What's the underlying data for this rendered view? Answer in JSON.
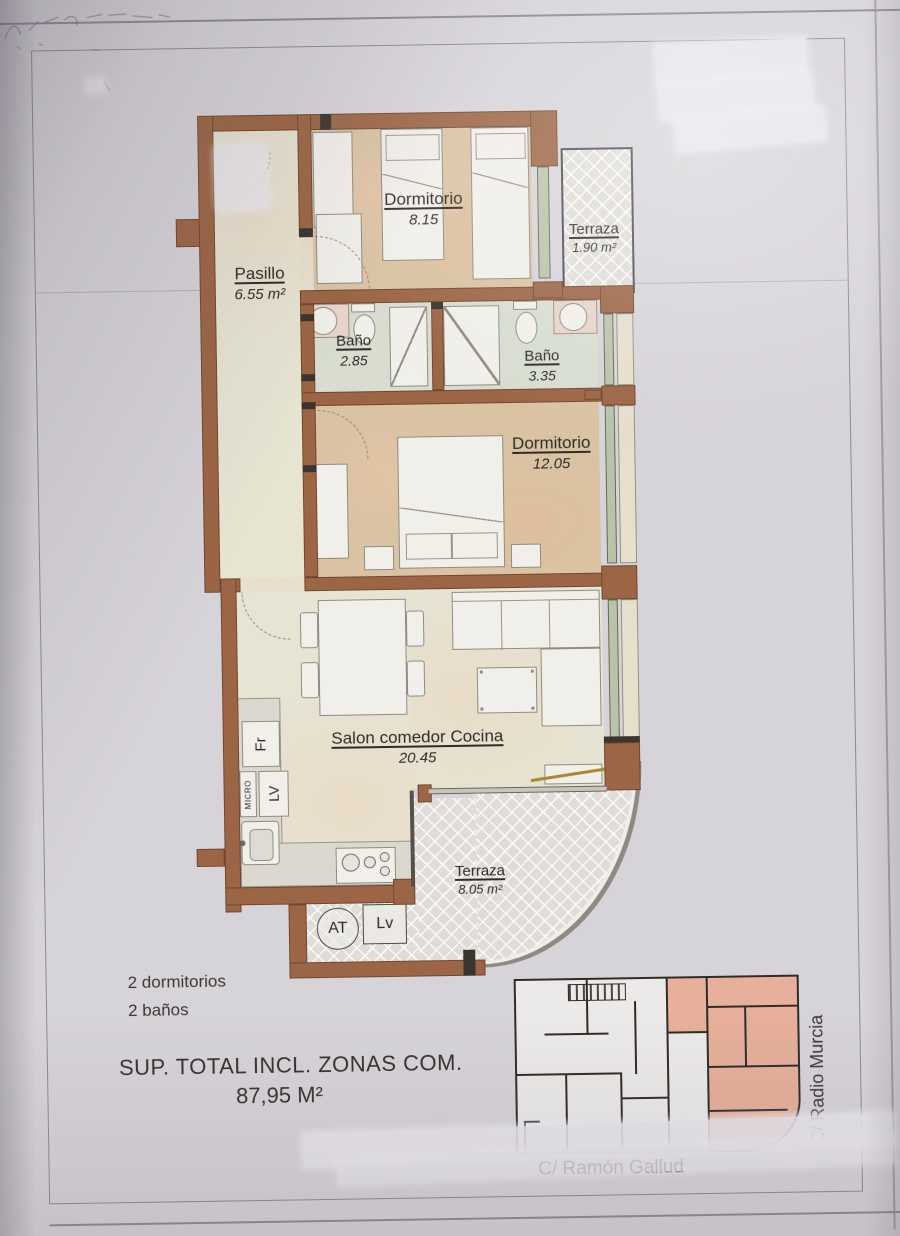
{
  "rooms": {
    "dormitorio1": {
      "label": "Dormitorio",
      "area": "8.15"
    },
    "terraza1": {
      "label": "Terraza",
      "area": "1.90 m²"
    },
    "pasillo": {
      "label": "Pasillo",
      "area": "6.55 m²"
    },
    "bano1": {
      "label": "Baño",
      "area": "2.85"
    },
    "bano2": {
      "label": "Baño",
      "area": "3.35"
    },
    "dormitorio2": {
      "label": "Dormitorio",
      "area": "12.05"
    },
    "salon": {
      "label": "Salon comedor Cocina",
      "area": "20.45"
    },
    "terraza2": {
      "label": "Terraza",
      "area": "8.05 m²"
    }
  },
  "kitchen_labels": {
    "fridge": "Fr",
    "microwave": "MICRO",
    "dishwasher": "LV"
  },
  "terrace_labels": {
    "water_heater": "AT",
    "laundry": "Lv"
  },
  "summary": {
    "bedrooms": "2 dormitorios",
    "bathrooms": "2 baños",
    "total_label": "SUP. TOTAL INCL. ZONAS COM.",
    "total_value": "87,95 M²"
  },
  "streets": {
    "bottom": "C/ Ramón Gallud",
    "right": "C/ Radio Murcia"
  },
  "colors": {
    "wall": "#9c6545",
    "floor_bedroom": "#d9c3a3",
    "floor_hall": "#e7e4d2",
    "floor_bath": "#d8ddd0",
    "terrace_tile": "#e0ddd8",
    "window_glass": "#b9c3aa",
    "unit_highlight": "#e6b09a",
    "paper": "#d7d4d9",
    "ink": "#2e2b28"
  }
}
